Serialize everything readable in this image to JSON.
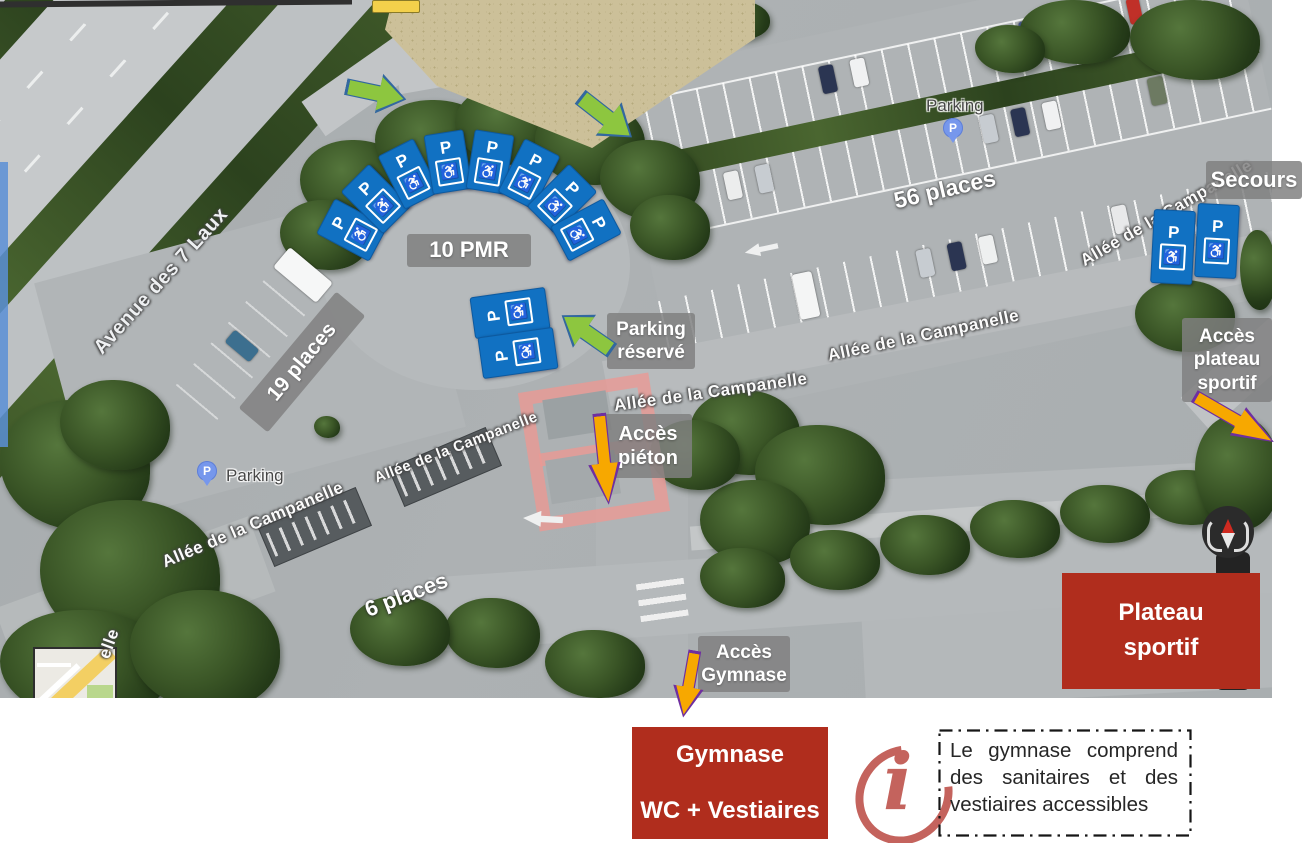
{
  "colors": {
    "annotation_red": "#b02d1d",
    "sign_blue": "#1171c2",
    "banner_gray": "#808080",
    "arrow_green": "#8dc63f",
    "arrow_green_outline": "#33689f",
    "arrow_orange": "#f7a800",
    "arrow_purple_outline": "#6f2fa0",
    "info_icon_red": "#c4635d",
    "poi_pin_blue": "#7697ec"
  },
  "map": {
    "street_labels": [
      {
        "text": "Avenue des 7 Laux"
      },
      {
        "text": "Allée de la Campanelle"
      },
      {
        "text": "Allée de la Campanelle"
      },
      {
        "text": "Allée de la Campanelle"
      },
      {
        "text": "Allée de la Campanelle"
      },
      {
        "text": "Allée de la Campanelle"
      },
      {
        "text": "elle"
      }
    ],
    "poi": {
      "label": "Parking",
      "pin_letter": "P"
    },
    "capacity": {
      "pmr": "10 PMR",
      "left_lot": "19 places",
      "right_lot": "56 places",
      "street": "6 places"
    },
    "banners": {
      "secours": "Secours",
      "parking_reserve": "Parking réservé",
      "acces_pieton": "Accès piéton",
      "acces_plateau": "Accès plateau sportif",
      "acces_gymnase": "Accès Gymnase"
    },
    "plateau_box": "Plateau sportif",
    "sign": {
      "letter": "P",
      "wheelchair": "♿"
    }
  },
  "footer": {
    "gymnase_title": "Gymnase",
    "gymnase_subtitle": "WC + Vestiaires",
    "info_icon": "i",
    "info_text": "Le gymnase comprend des sanitaires et des vestiaires accessibles"
  }
}
